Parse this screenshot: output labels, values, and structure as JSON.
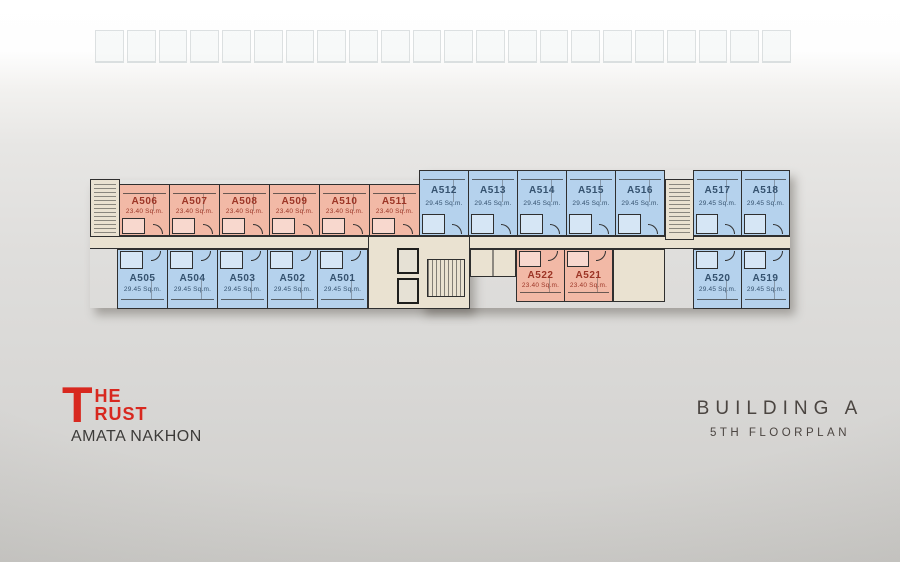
{
  "logo": {
    "t": "T",
    "he": "HE",
    "rust": "RUST",
    "subtitle": "AMATA NAKHON",
    "brand_color": "#d8281f"
  },
  "title": {
    "building": "BUILDING A",
    "floorplan": "5TH FLOORPLAN",
    "color": "#4b4541"
  },
  "floorplan": {
    "colors": {
      "small_unit_fill": "#f2b9a6",
      "large_unit_fill": "#b5d2ed",
      "small_unit_label": "#9c3526",
      "large_unit_label": "#35526f",
      "core_fill": "#eae2d1",
      "outline": "#2f2f2f"
    },
    "rows": [
      {
        "id": "top-left",
        "type": "small",
        "orientation": "down",
        "units": [
          {
            "label": "A506",
            "area": "23.40 Sq.m."
          },
          {
            "label": "A507",
            "area": "23.40 Sq.m."
          },
          {
            "label": "A508",
            "area": "23.40 Sq.m."
          },
          {
            "label": "A509",
            "area": "23.40 Sq.m."
          },
          {
            "label": "A510",
            "area": "23.40 Sq.m."
          },
          {
            "label": "A511",
            "area": "23.40 Sq.m."
          }
        ]
      },
      {
        "id": "bottom-left",
        "type": "large",
        "orientation": "up",
        "units": [
          {
            "label": "A505",
            "area": "29.45 Sq.m."
          },
          {
            "label": "A504",
            "area": "29.45 Sq.m."
          },
          {
            "label": "A503",
            "area": "29.45 Sq.m."
          },
          {
            "label": "A502",
            "area": "29.45 Sq.m."
          },
          {
            "label": "A501",
            "area": "29.45 Sq.m."
          }
        ]
      },
      {
        "id": "top-right",
        "type": "large",
        "orientation": "down",
        "units": [
          {
            "label": "A512",
            "area": "29.45 Sq.m."
          },
          {
            "label": "A513",
            "area": "29.45 Sq.m."
          },
          {
            "label": "A514",
            "area": "29.45 Sq.m."
          },
          {
            "label": "A515",
            "area": "29.45 Sq.m."
          },
          {
            "label": "A516",
            "area": "29.45 Sq.m."
          }
        ]
      },
      {
        "id": "top-right-end",
        "type": "large",
        "orientation": "down",
        "units": [
          {
            "label": "A517",
            "area": "29.45 Sq.m."
          },
          {
            "label": "A518",
            "area": "29.45 Sq.m."
          }
        ]
      },
      {
        "id": "bottom-mid",
        "type": "small",
        "orientation": "up",
        "units": [
          {
            "label": "A522",
            "area": "23.40 Sq.m."
          },
          {
            "label": "A521",
            "area": "23.40 Sq.m."
          }
        ]
      },
      {
        "id": "bottom-right-end",
        "type": "large",
        "orientation": "up",
        "units": [
          {
            "label": "A520",
            "area": "29.45 Sq.m."
          },
          {
            "label": "A519",
            "area": "29.45 Sq.m."
          }
        ]
      }
    ]
  }
}
